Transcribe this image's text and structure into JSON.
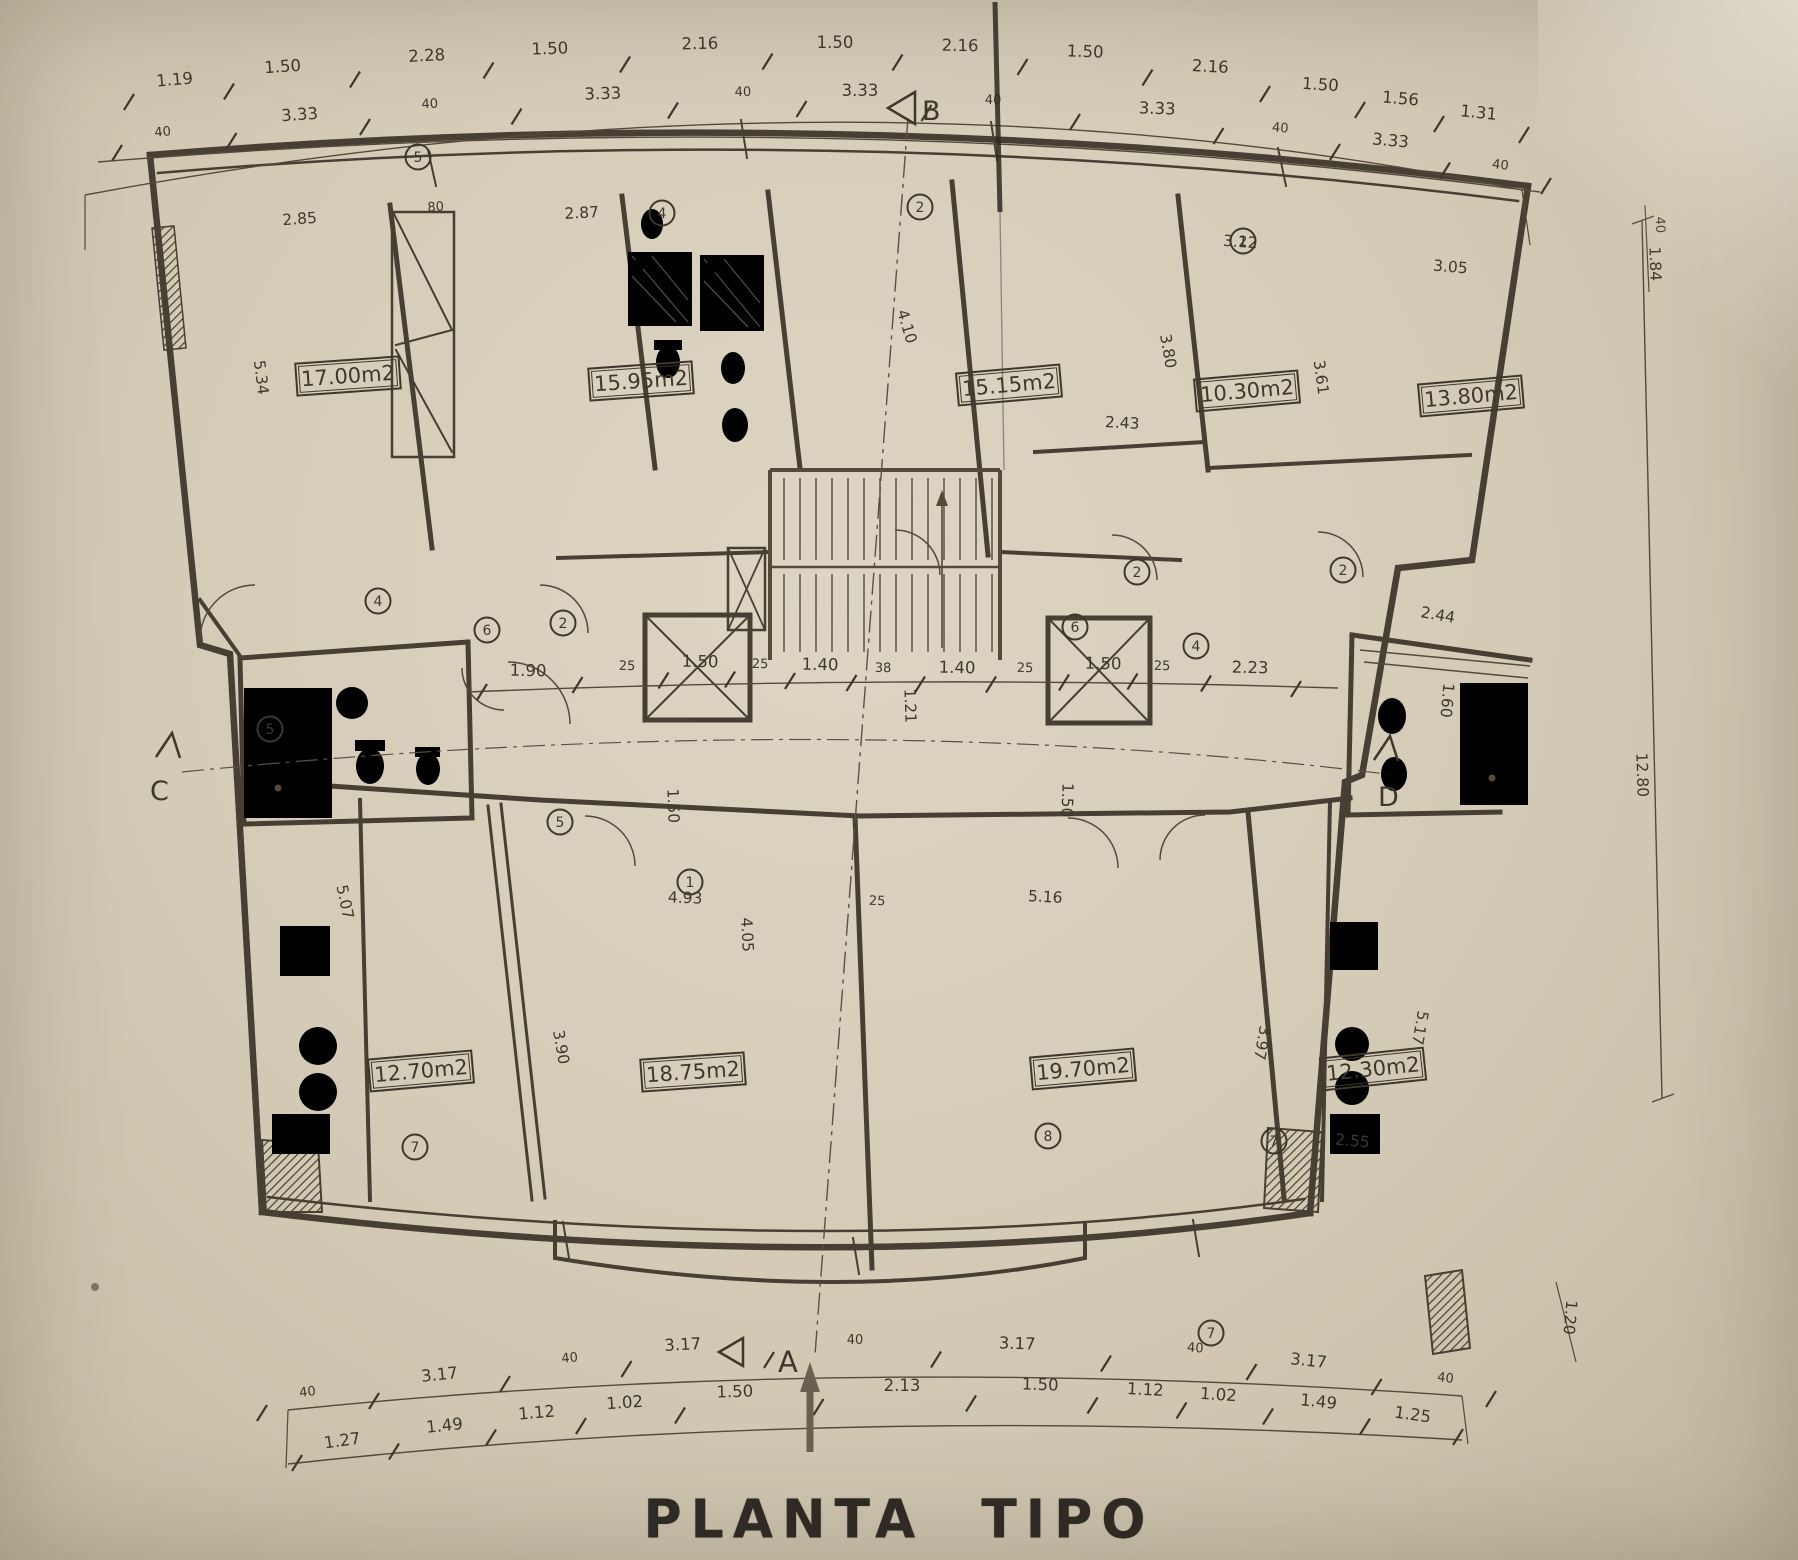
{
  "title": "PLANTA TIPO",
  "room_areas": [
    "17.00m2",
    "15.95m2",
    "15.15m2",
    "10.30m2",
    "13.80m2",
    "12.70m2",
    "18.75m2",
    "19.70m2",
    "12.30m2"
  ],
  "section_markers": {
    "top": "B",
    "bottom": "A",
    "left": "C",
    "right": "D"
  },
  "dims": {
    "top_outer": [
      "1.19",
      "1.50",
      "2.28",
      "1.50",
      "2.16",
      "1.50",
      "2.16",
      "1.50",
      "2.16",
      "1.50",
      "1.56",
      "1.31"
    ],
    "top_inner": [
      "40",
      "3.33",
      "40",
      "3.33",
      "40",
      "3.33",
      "40",
      "3.33",
      "40",
      "3.33",
      "40"
    ],
    "core_chain": [
      "1.90",
      "25",
      "1.50",
      "25",
      "1.40",
      "38",
      "1.40",
      "25",
      "1.50",
      "25",
      "2.23"
    ],
    "bottom_inner": [
      "40",
      "3.17",
      "40",
      "3.17",
      "40",
      "3.17",
      "40",
      "3.17",
      "40"
    ],
    "bottom_outer": [
      "1.27",
      "1.49",
      "1.12",
      "1.02",
      "1.50",
      "2.13",
      "1.50",
      "1.12",
      "1.02",
      "1.49",
      "1.25"
    ],
    "interior": [
      "2.85",
      "80",
      "2.87",
      "5.34",
      "4.10",
      "3.80",
      "3.12",
      "2.43",
      "3.61",
      "3.05",
      "4.93",
      "25",
      "5.16",
      "4.05",
      "3.90",
      "5.07",
      "3.97",
      "5.17",
      "2.55",
      "1.50",
      "1.50",
      "1.21",
      "2.44",
      "1.60",
      "12.80",
      "1.20",
      "40",
      "1.84"
    ]
  },
  "room_tags": [
    "5",
    "4",
    "2",
    "2",
    "2",
    "6",
    "4",
    "5",
    "5",
    "1",
    "2",
    "2",
    "6",
    "4",
    "7",
    "8",
    "7",
    "7"
  ]
}
